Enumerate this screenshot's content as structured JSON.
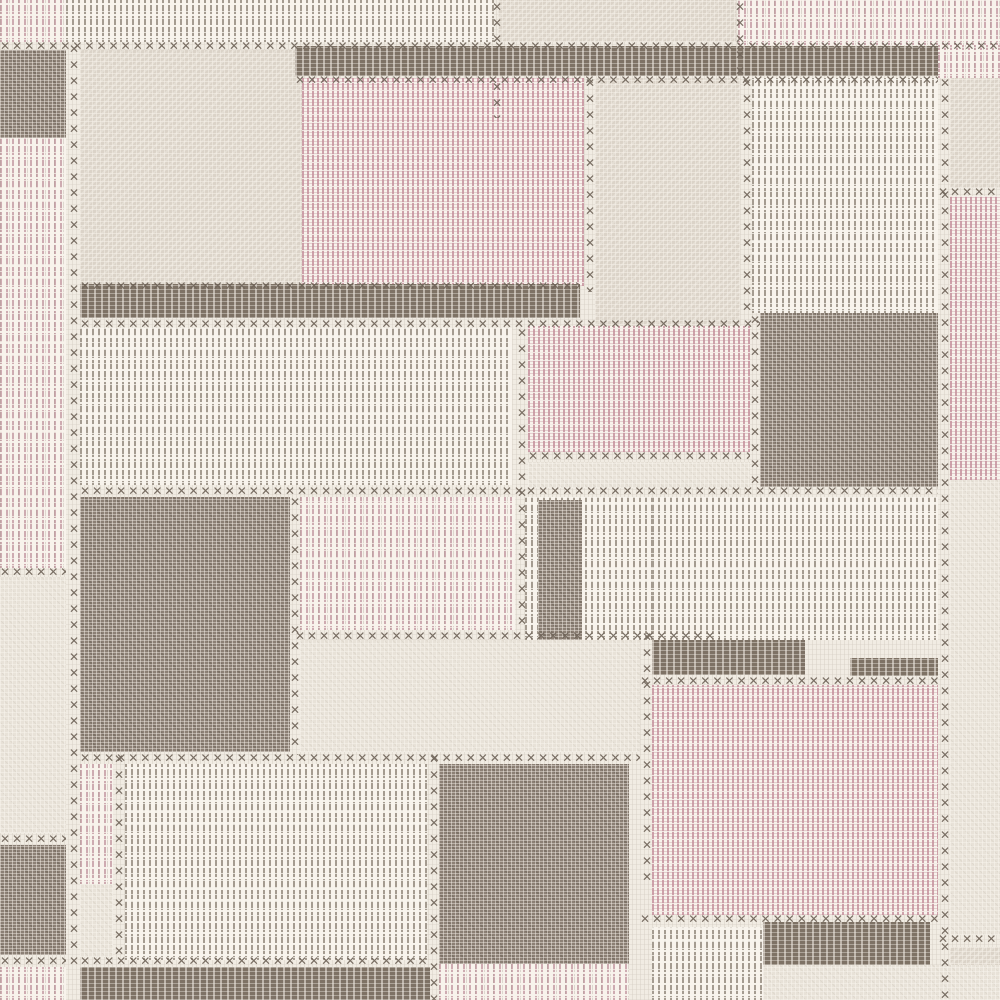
{
  "artwork": {
    "kind": "wallpaper-patchwork-swatch",
    "description": "Patchwork textile wallpaper pattern of woven rectangles in cream, greige, dusty pink and dark taupe joined by cross-stitch seams"
  },
  "canvas": {
    "width": 1000,
    "height": 1000
  },
  "palette": {
    "cream": "#f1ece3",
    "texbg": "#f8f3ec",
    "beige": "#dbd3c8",
    "beigelight": "#e8e2d8",
    "dark": "#8c8075",
    "darkband": "#7e7265",
    "pinkweave": "#c6939e",
    "pinkdash": "#c499a2",
    "graydash": "#968c80",
    "stitch": "#6f6459"
  },
  "stitch_glyph": "✕",
  "patches": [
    {
      "n": "top-strip-pink-dash-left",
      "t": "dashpink",
      "x": 0,
      "y": 0,
      "w": 66,
      "h": 42
    },
    {
      "n": "top-strip-gray-dash",
      "t": "dashgray",
      "x": 66,
      "y": 0,
      "w": 428,
      "h": 42
    },
    {
      "n": "top-strip-beige",
      "t": "beige",
      "x": 498,
      "y": 0,
      "w": 238,
      "h": 42
    },
    {
      "n": "top-strip-pink-right",
      "t": "dashpink",
      "x": 738,
      "y": 0,
      "w": 262,
      "h": 45
    },
    {
      "n": "top-right-pink-stub",
      "t": "dashpink",
      "x": 938,
      "y": 45,
      "w": 62,
      "h": 33
    },
    {
      "n": "left-dark-top",
      "t": "dark",
      "x": 0,
      "y": 50,
      "w": 66,
      "h": 88
    },
    {
      "n": "left-pink-dash",
      "t": "dashpink",
      "x": 0,
      "y": 138,
      "w": 66,
      "h": 430
    },
    {
      "n": "left-beige-light",
      "t": "beigelight",
      "x": 0,
      "y": 577,
      "w": 66,
      "h": 256
    },
    {
      "n": "left-dark-bottom",
      "t": "dark",
      "x": 0,
      "y": 845,
      "w": 66,
      "h": 110
    },
    {
      "n": "left-pink-dash-bottom",
      "t": "dashpink",
      "x": 0,
      "y": 967,
      "w": 66,
      "h": 33
    },
    {
      "n": "beige-block-top",
      "t": "beige",
      "x": 80,
      "y": 50,
      "w": 222,
      "h": 236
    },
    {
      "n": "pink-woven-top",
      "t": "pink",
      "x": 302,
      "y": 78,
      "w": 282,
      "h": 208
    },
    {
      "n": "beige-block-right",
      "t": "beige",
      "x": 595,
      "y": 78,
      "w": 145,
      "h": 255
    },
    {
      "n": "gray-dash-top-right",
      "t": "dashgray",
      "x": 752,
      "y": 78,
      "w": 186,
      "h": 235
    },
    {
      "n": "beige-right-edge",
      "t": "beige",
      "x": 950,
      "y": 78,
      "w": 50,
      "h": 110
    },
    {
      "n": "pink-right-edge",
      "t": "pink",
      "x": 950,
      "y": 196,
      "w": 50,
      "h": 284
    },
    {
      "n": "dark-band-top",
      "t": "darkband",
      "x": 295,
      "y": 46,
      "w": 643,
      "h": 30
    },
    {
      "n": "dark-band-mid",
      "t": "darkband",
      "x": 80,
      "y": 284,
      "w": 500,
      "h": 34
    },
    {
      "n": "gray-dash-middle",
      "t": "dashgray",
      "x": 80,
      "y": 328,
      "w": 432,
      "h": 157
    },
    {
      "n": "pink-woven-middle",
      "t": "pink",
      "x": 528,
      "y": 326,
      "w": 222,
      "h": 126
    },
    {
      "n": "beige-strip-middle",
      "t": "beigelight",
      "x": 528,
      "y": 462,
      "w": 222,
      "h": 26
    },
    {
      "n": "dark-square-right",
      "t": "dark",
      "x": 760,
      "y": 313,
      "w": 178,
      "h": 174
    },
    {
      "n": "dark-square-left",
      "t": "dark",
      "x": 80,
      "y": 497,
      "w": 210,
      "h": 255
    },
    {
      "n": "pink-dash-middle",
      "t": "dashpink",
      "x": 300,
      "y": 497,
      "w": 215,
      "h": 133
    },
    {
      "n": "gray-dash-center",
      "t": "dashgray",
      "x": 525,
      "y": 497,
      "w": 127,
      "h": 143
    },
    {
      "n": "dark-strip-center",
      "t": "dark",
      "x": 538,
      "y": 500,
      "w": 44,
      "h": 140
    },
    {
      "n": "gray-dash-right",
      "t": "dashgray",
      "x": 652,
      "y": 497,
      "w": 286,
      "h": 143
    },
    {
      "n": "beige-strip-lower",
      "t": "beigelight",
      "x": 300,
      "y": 640,
      "w": 340,
      "h": 112
    },
    {
      "n": "dark-band-center-right",
      "t": "darkband",
      "x": 652,
      "y": 640,
      "w": 153,
      "h": 35
    },
    {
      "n": "dark-band-right-stub",
      "t": "darkband",
      "x": 850,
      "y": 658,
      "w": 88,
      "h": 18
    },
    {
      "n": "pink-woven-bottom-right",
      "t": "pink",
      "x": 652,
      "y": 685,
      "w": 286,
      "h": 230
    },
    {
      "n": "beige-light-right-edge",
      "t": "beigelight",
      "x": 950,
      "y": 480,
      "w": 50,
      "h": 455
    },
    {
      "n": "beige-right-bottom",
      "t": "beige",
      "x": 950,
      "y": 947,
      "w": 50,
      "h": 53
    },
    {
      "n": "pink-dash-bottom-left",
      "t": "dashpink",
      "x": 80,
      "y": 764,
      "w": 33,
      "h": 120
    },
    {
      "n": "beige-light-bottom-left",
      "t": "beigelight",
      "x": 80,
      "y": 884,
      "w": 33,
      "h": 73
    },
    {
      "n": "gray-dash-bottom",
      "t": "dashgray",
      "x": 125,
      "y": 764,
      "w": 302,
      "h": 196
    },
    {
      "n": "dark-square-bottom",
      "t": "dark",
      "x": 439,
      "y": 764,
      "w": 190,
      "h": 200
    },
    {
      "n": "pink-dash-bottom-center",
      "t": "dashpink",
      "x": 439,
      "y": 964,
      "w": 190,
      "h": 36
    },
    {
      "n": "gray-dash-bottom-right",
      "t": "dashgray",
      "x": 652,
      "y": 927,
      "w": 113,
      "h": 73
    },
    {
      "n": "dark-band-bottom-right",
      "t": "darkband",
      "x": 763,
      "y": 922,
      "w": 167,
      "h": 43
    },
    {
      "n": "beige-strip-bottom-right",
      "t": "beigelight",
      "x": 763,
      "y": 965,
      "w": 237,
      "h": 35
    },
    {
      "n": "dark-band-bottom-left",
      "t": "darkband",
      "x": 80,
      "y": 967,
      "w": 350,
      "h": 33
    }
  ],
  "stitches": {
    "rows": [
      [
        0,
        40,
        1000
      ],
      [
        295,
        74,
        643
      ],
      [
        80,
        280,
        500
      ],
      [
        80,
        318,
        680
      ],
      [
        528,
        450,
        222
      ],
      [
        80,
        485,
        858
      ],
      [
        295,
        630,
        425
      ],
      [
        0,
        566,
        66
      ],
      [
        80,
        752,
        560
      ],
      [
        640,
        675,
        298
      ],
      [
        0,
        833,
        66
      ],
      [
        640,
        913,
        298
      ],
      [
        80,
        955,
        350
      ],
      [
        0,
        955,
        66
      ],
      [
        938,
        186,
        62
      ],
      [
        938,
        933,
        62
      ]
    ],
    "cols": [
      [
        67,
        42,
        923
      ],
      [
        288,
        495,
        260
      ],
      [
        515,
        326,
        306
      ],
      [
        583,
        76,
        216
      ],
      [
        733,
        0,
        78
      ],
      [
        748,
        313,
        176
      ],
      [
        740,
        76,
        239
      ],
      [
        938,
        76,
        924
      ],
      [
        427,
        752,
        248
      ],
      [
        640,
        630,
        252
      ],
      [
        112,
        752,
        210
      ],
      [
        490,
        0,
        44
      ],
      [
        490,
        80,
        38
      ]
    ]
  }
}
